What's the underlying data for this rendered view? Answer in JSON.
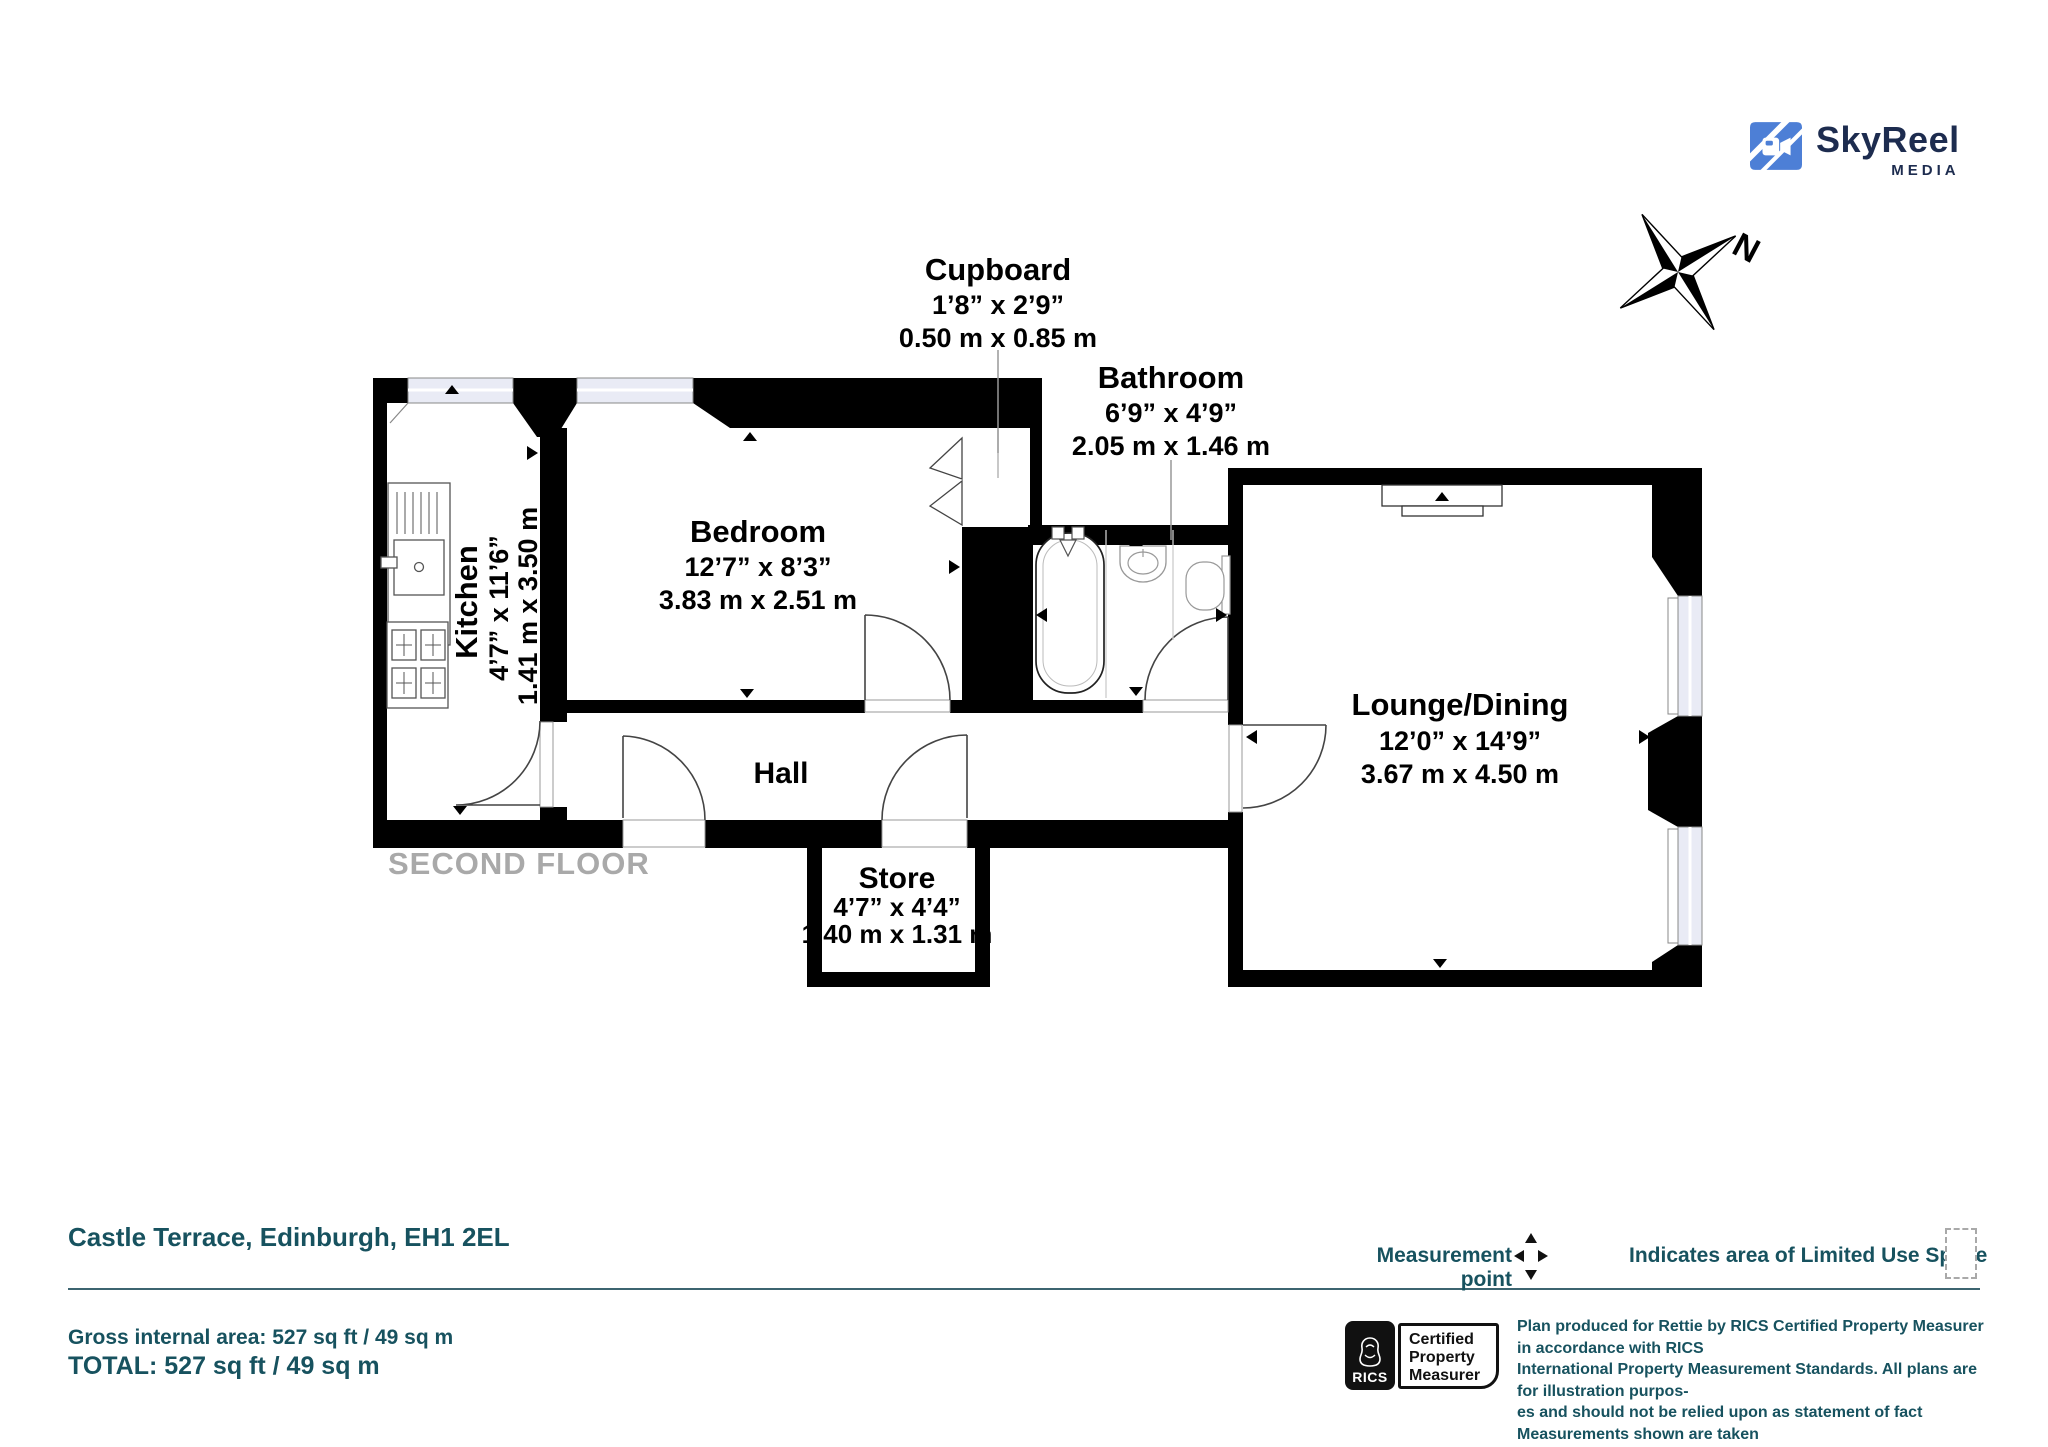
{
  "branding": {
    "logo_text": "SkyReel",
    "logo_subtext": "MEDIA"
  },
  "compass": {
    "label": "N"
  },
  "floor_label": "SECOND FLOOR",
  "rooms": {
    "cupboard": {
      "name": "Cupboard",
      "imperial": "1’8” x 2’9”",
      "metric": "0.50 m x 0.85 m"
    },
    "bathroom": {
      "name": "Bathroom",
      "imperial": "6’9” x 4’9”",
      "metric": "2.05 m x 1.46 m"
    },
    "kitchen": {
      "name": "Kitchen",
      "imperial": "4’7” x 11’6”",
      "metric": "1.41 m x 3.50 m"
    },
    "bedroom": {
      "name": "Bedroom",
      "imperial": "12’7” x 8’3”",
      "metric": "3.83 m x 2.51 m"
    },
    "hall": {
      "name": "Hall"
    },
    "store": {
      "name": "Store",
      "imperial": "4’7” x 4’4”",
      "metric": "1.40 m x 1.31 m"
    },
    "lounge": {
      "name": "Lounge/Dining",
      "imperial": "12’0” x 14’9”",
      "metric": "3.67 m x 4.50 m"
    }
  },
  "footer": {
    "address": "Castle Terrace, Edinburgh, EH1 2EL",
    "gross_area": "Gross internal area: 527 sq ft / 49 sq m",
    "total": "TOTAL: 527 sq ft / 49 sq m",
    "measurement_point_label": "Measurement point",
    "limited_use_label": "Indicates area of Limited Use Space",
    "rics_badge": {
      "brand": "RICS",
      "line1": "Certified",
      "line2": "Property",
      "line3": "Measurer"
    },
    "disclaimer_lines": [
      "Plan produced for Rettie by RICS Certified Property Measurer in accordance with RICS",
      "International Property Measurement Standards. All plans are for illustration purpos-",
      "es and should not be relied upon as statement of fact Measurements shown are taken",
      "from points indicated. Areas with curved and angled walls are approximated."
    ]
  },
  "colors": {
    "accent_teal": "#17525f",
    "logo_blue": "#4d7fd6",
    "logo_navy": "#1d2c4f",
    "window_fill": "#e9ebf5",
    "floor_label_gray": "#a9a9a9"
  }
}
